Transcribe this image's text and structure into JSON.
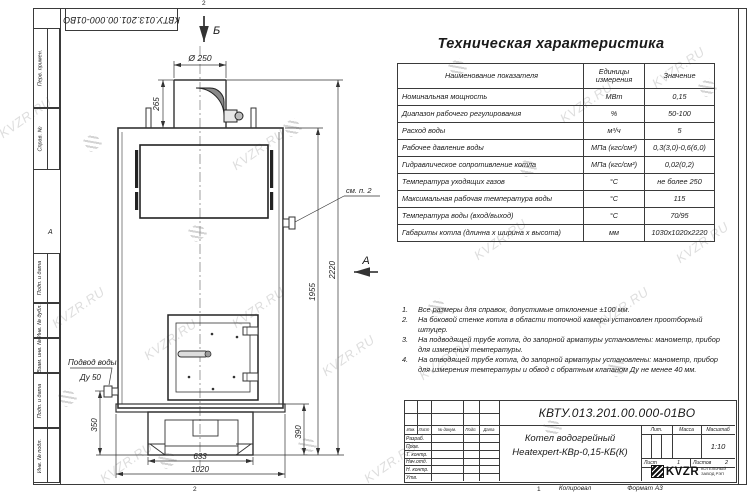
{
  "frame": {
    "doc_number_top": "КВТУ.013.201.00.000-01ВО",
    "left_fields": [
      "Перв. примен.",
      "Справ. №",
      "Подп. и дата",
      "Инв. № дубл.",
      "Взам. инв. №",
      "Подп. и дата",
      "Инв. № подл."
    ],
    "zone_top": "2",
    "zone_left": "А",
    "zone_bottom": "2",
    "zone_bottom_right": "1",
    "footer_copied": "Копировал",
    "footer_format": "Формат А3"
  },
  "spec_table": {
    "title": "Техническая характеристика",
    "headers": [
      "Наименование показателя",
      "Единицы измерения",
      "Значение"
    ],
    "rows": [
      [
        "Номинальная мощность",
        "МВт",
        "0,15"
      ],
      [
        "Диапазон рабочего регулирования",
        "%",
        "50-100"
      ],
      [
        "Расход воды",
        "м³/ч",
        "5"
      ],
      [
        "Рабочее давление воды",
        "МПа (кгс/см²)",
        "0,3(3,0)-0,6(6,0)"
      ],
      [
        "Гидравлическое сопротивление котла",
        "МПа (кгс/см²)",
        "0,02(0,2)"
      ],
      [
        "Температура уходящих газов",
        "°С",
        "не более 250"
      ],
      [
        "Максимальная рабочая температура воды",
        "°С",
        "115"
      ],
      [
        "Температура воды (вход/выход)",
        "°С",
        "70/95"
      ],
      [
        "Габариты котла (длинна х ширина х высота)",
        "мм",
        "1030х1020х2220"
      ]
    ]
  },
  "notes": {
    "items": [
      {
        "num": "1.",
        "text": "Все размеры для справок, допустимые отклонение ±100 мм."
      },
      {
        "num": "2.",
        "text": "На боковой стенке котла в области топочной камеры установлен проотборный штуцер."
      },
      {
        "num": "3.",
        "text": "На подводящей трубе котла, до запорной арматуры установлены: манометр, прибор для измерения температуры."
      },
      {
        "num": "4.",
        "text": "На отводящей трубе котла, до запорной арматуры установлены: манометр, прибор для измерения температуры и обвод с обратным клапаном Ду не менее 40 мм."
      }
    ]
  },
  "drawing": {
    "view_arrow_top": "Б",
    "view_arrow_side": "А",
    "dims": {
      "chimney_dia": "Ø 250",
      "chimney_h": "265",
      "body_h": "1955",
      "total_h": "2220",
      "base_h": "390",
      "inlet_h": "350",
      "base_w": "633",
      "total_w": "1020"
    },
    "labels": {
      "see_note": "см. п. 2",
      "water_inlet_1": "Подвод воды",
      "water_inlet_2": "Ду 50"
    }
  },
  "title_block": {
    "doc_number": "КВТУ.013.201.00.000-01ВО",
    "product_name_1": "Котел водогрейный",
    "product_name_2": "Heatexpert-КВр-0,15-КБ(К)",
    "rev_headers": [
      "Изм.",
      "Лист",
      "№ докум.",
      "Подп.",
      "Дата"
    ],
    "sig_rows": [
      "Разраб.",
      "Пров.",
      "Т. контр.",
      "Нач.отд.",
      "Н. контр.",
      "Утв."
    ],
    "lit_label": "Лит.",
    "mass_label": "Масса",
    "scale_label": "Масштаб",
    "scale_value": "1:10",
    "sheet_label": "Лист",
    "sheet_value": "1",
    "sheets_label": "Листов",
    "sheets_value": "2",
    "logo_text": "KVZR",
    "logo_sub_1": "КОТЕЛЬНЫЙ",
    "logo_sub_2": "ЗАВОД РЭП"
  },
  "watermark": {
    "text": "KVZR.RU"
  }
}
